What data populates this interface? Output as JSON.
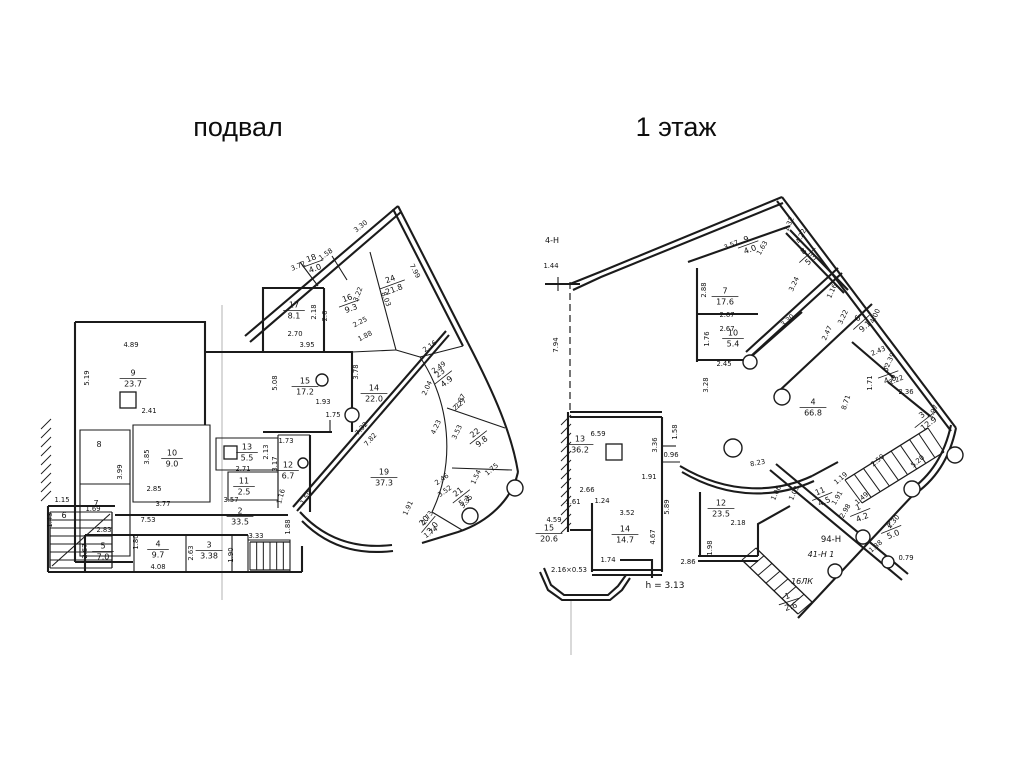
{
  "page": {
    "background": "#ffffff",
    "line_color": "#1b1b1b"
  },
  "plans": [
    {
      "id": "basement",
      "title": "подвал",
      "rooms": [
        {
          "n": "9",
          "a": "23.7",
          "x": 133,
          "y": 378
        },
        {
          "n": "10",
          "a": "9.0",
          "x": 172,
          "y": 458
        },
        {
          "n": "13",
          "a": "5.5",
          "x": 247,
          "y": 452
        },
        {
          "n": "11",
          "a": "2.5",
          "x": 244,
          "y": 486
        },
        {
          "n": "12",
          "a": "6.7",
          "x": 288,
          "y": 470
        },
        {
          "n": "5",
          "a": "7.0",
          "x": 103,
          "y": 551
        },
        {
          "n": "4",
          "a": "9.7",
          "x": 158,
          "y": 549
        },
        {
          "n": "3",
          "a": "3.38",
          "x": 209,
          "y": 550
        },
        {
          "n": "2",
          "a": "33.5",
          "x": 240,
          "y": 516
        },
        {
          "n": "15",
          "a": "17.2",
          "x": 305,
          "y": 386
        },
        {
          "n": "17",
          "a": "8.1",
          "x": 294,
          "y": 310
        },
        {
          "n": "16",
          "a": "9.3",
          "x": 349,
          "y": 303,
          "r": -20
        },
        {
          "n": "18",
          "a": "4.0",
          "x": 313,
          "y": 263,
          "r": -20
        },
        {
          "n": "24",
          "a": "21.8",
          "x": 392,
          "y": 284,
          "r": -20
        },
        {
          "n": "14",
          "a": "22.0",
          "x": 374,
          "y": 393
        },
        {
          "n": "19",
          "a": "37.3",
          "x": 384,
          "y": 477
        },
        {
          "n": "23",
          "a": "4.9",
          "x": 443,
          "y": 377,
          "r": -38
        },
        {
          "n": "22",
          "a": "9.8",
          "x": 478,
          "y": 437,
          "r": -38
        },
        {
          "n": "21",
          "a": "5.1",
          "x": 461,
          "y": 496,
          "r": -38
        },
        {
          "n": "20",
          "a": "3.0",
          "x": 428,
          "y": 524,
          "r": -50
        }
      ],
      "dims": [
        {
          "t": "4.89",
          "x": 131,
          "y": 347
        },
        {
          "t": "5.19",
          "x": 89,
          "y": 378,
          "r": -90
        },
        {
          "t": "2.41",
          "x": 149,
          "y": 413
        },
        {
          "t": "8",
          "x": 99,
          "y": 447,
          "s": 8
        },
        {
          "t": "7",
          "x": 96,
          "y": 506,
          "s": 8
        },
        {
          "t": "6",
          "x": 64,
          "y": 518,
          "s": 8
        },
        {
          "t": "3.99",
          "x": 122,
          "y": 472,
          "r": -90
        },
        {
          "t": "3.85",
          "x": 149,
          "y": 457,
          "r": -90
        },
        {
          "t": "2.85",
          "x": 154,
          "y": 491
        },
        {
          "t": "1.15",
          "x": 62,
          "y": 502
        },
        {
          "t": "1.69",
          "x": 93,
          "y": 511
        },
        {
          "t": "1.43",
          "x": 52,
          "y": 520,
          "r": -90
        },
        {
          "t": "2.83",
          "x": 104,
          "y": 532
        },
        {
          "t": "2.67",
          "x": 87,
          "y": 551,
          "r": -90
        },
        {
          "t": "7.53",
          "x": 148,
          "y": 522
        },
        {
          "t": "1.80",
          "x": 138,
          "y": 542,
          "r": -90
        },
        {
          "t": "4.08",
          "x": 158,
          "y": 569
        },
        {
          "t": "2.63",
          "x": 193,
          "y": 553,
          "r": -90
        },
        {
          "t": "1.90",
          "x": 233,
          "y": 555,
          "r": -90
        },
        {
          "t": "3.33",
          "x": 256,
          "y": 538
        },
        {
          "t": "3.77",
          "x": 163,
          "y": 506
        },
        {
          "t": "3.57",
          "x": 231,
          "y": 502
        },
        {
          "t": "2.71",
          "x": 243,
          "y": 471
        },
        {
          "t": "2.13",
          "x": 268,
          "y": 452,
          "r": -90
        },
        {
          "t": "3.17",
          "x": 277,
          "y": 464,
          "r": -90
        },
        {
          "t": "1.73",
          "x": 286,
          "y": 443
        },
        {
          "t": "1.16",
          "x": 283,
          "y": 497,
          "r": -75
        },
        {
          "t": "1.59",
          "x": 308,
          "y": 499,
          "r": -55
        },
        {
          "t": "1.88",
          "x": 290,
          "y": 527,
          "r": -90
        },
        {
          "t": "2.70",
          "x": 295,
          "y": 336
        },
        {
          "t": "3.95",
          "x": 307,
          "y": 347
        },
        {
          "t": "5.08",
          "x": 277,
          "y": 383,
          "r": -90
        },
        {
          "t": "1.93",
          "x": 323,
          "y": 404
        },
        {
          "t": "1.75",
          "x": 333,
          "y": 417
        },
        {
          "t": "2.18",
          "x": 316,
          "y": 312,
          "r": -90
        },
        {
          "t": "2.6",
          "x": 327,
          "y": 316,
          "r": -90
        },
        {
          "t": "3.72",
          "x": 299,
          "y": 268,
          "r": -22
        },
        {
          "t": "1.58",
          "x": 327,
          "y": 256,
          "r": -35
        },
        {
          "t": "3.30",
          "x": 362,
          "y": 228,
          "r": -38
        },
        {
          "t": "7.99",
          "x": 413,
          "y": 272,
          "r": 62
        },
        {
          "t": "3.22",
          "x": 360,
          "y": 295,
          "r": -70
        },
        {
          "t": "8.03",
          "x": 384,
          "y": 300,
          "r": 68
        },
        {
          "t": "2.25",
          "x": 361,
          "y": 324,
          "r": -28
        },
        {
          "t": "1.88",
          "x": 366,
          "y": 338,
          "r": -28
        },
        {
          "t": "7.32",
          "x": 363,
          "y": 430,
          "r": -48
        },
        {
          "t": "7.82",
          "x": 372,
          "y": 441,
          "r": -48
        },
        {
          "t": "3.78",
          "x": 358,
          "y": 372,
          "r": -90
        },
        {
          "t": "2.87",
          "x": 462,
          "y": 402,
          "r": -60
        },
        {
          "t": "2.04",
          "x": 429,
          "y": 389,
          "r": -65
        },
        {
          "t": "2.49",
          "x": 440,
          "y": 369,
          "r": -35
        },
        {
          "t": "2.16",
          "x": 431,
          "y": 348,
          "r": -35
        },
        {
          "t": "2.27",
          "x": 461,
          "y": 406,
          "r": -40
        },
        {
          "t": "4.23",
          "x": 438,
          "y": 428,
          "r": -65
        },
        {
          "t": "3.53",
          "x": 459,
          "y": 433,
          "r": -65
        },
        {
          "t": "1.75",
          "x": 493,
          "y": 471,
          "r": -40
        },
        {
          "t": "2.46",
          "x": 443,
          "y": 481,
          "r": -35
        },
        {
          "t": "3.52",
          "x": 446,
          "y": 493,
          "r": -35
        },
        {
          "t": "1.54",
          "x": 478,
          "y": 478,
          "r": -65
        },
        {
          "t": "3.35",
          "x": 468,
          "y": 503,
          "r": -50
        },
        {
          "t": "1.91",
          "x": 410,
          "y": 509,
          "r": -65
        },
        {
          "t": "2.73",
          "x": 429,
          "y": 519,
          "r": -55
        },
        {
          "t": "1.74",
          "x": 432,
          "y": 534,
          "r": -35
        }
      ]
    },
    {
      "id": "floor1",
      "title": "1 этаж",
      "rooms": [
        {
          "n": "9",
          "a": "4.0",
          "x": 748,
          "y": 244,
          "r": -20
        },
        {
          "n": "7",
          "a": "17.6",
          "x": 725,
          "y": 296
        },
        {
          "n": "10",
          "a": "5.4",
          "x": 733,
          "y": 338
        },
        {
          "n": "8",
          "a": "5.3",
          "x": 807,
          "y": 255,
          "r": -42
        },
        {
          "n": "6",
          "a": "9.1",
          "x": 861,
          "y": 322,
          "r": -42
        },
        {
          "n": "5",
          "a": "4.0",
          "x": 888,
          "y": 374,
          "r": -20
        },
        {
          "n": "3",
          "a": "12.9",
          "x": 925,
          "y": 419,
          "r": -38
        },
        {
          "n": "4",
          "a": "66.8",
          "x": 813,
          "y": 407
        },
        {
          "n": "13",
          "a": "36.2",
          "x": 580,
          "y": 444
        },
        {
          "n": "14",
          "a": "14.7",
          "x": 625,
          "y": 534
        },
        {
          "n": "15",
          "a": "20.6",
          "x": 549,
          "y": 533
        },
        {
          "n": "12",
          "a": "23.5",
          "x": 721,
          "y": 508
        },
        {
          "n": "11",
          "a": "4.5",
          "x": 822,
          "y": 496,
          "r": -22
        },
        {
          "n": "1",
          "a": "4.2",
          "x": 860,
          "y": 512,
          "r": -22
        },
        {
          "n": "2",
          "a": "5.0",
          "x": 891,
          "y": 529,
          "r": -22
        },
        {
          "n": "1",
          "a": "2.6",
          "x": 789,
          "y": 601,
          "r": -18
        }
      ],
      "dims": [
        {
          "t": "4-Н",
          "x": 552,
          "y": 243,
          "s": 8
        },
        {
          "t": "1.44",
          "x": 551,
          "y": 268
        },
        {
          "t": "7.94",
          "x": 558,
          "y": 345,
          "r": -90
        },
        {
          "t": "3.57",
          "x": 732,
          "y": 247,
          "r": -22
        },
        {
          "t": "1.63",
          "x": 764,
          "y": 249,
          "r": -60
        },
        {
          "t": "2.88",
          "x": 706,
          "y": 290,
          "r": -90
        },
        {
          "t": "2.67",
          "x": 727,
          "y": 317
        },
        {
          "t": "2.67",
          "x": 727,
          "y": 331
        },
        {
          "t": "1.76",
          "x": 709,
          "y": 339,
          "r": -90
        },
        {
          "t": "2.45",
          "x": 724,
          "y": 366
        },
        {
          "t": "3.30",
          "x": 789,
          "y": 322,
          "r": -42
        },
        {
          "t": "3.24",
          "x": 796,
          "y": 285,
          "r": -65
        },
        {
          "t": "1.16",
          "x": 834,
          "y": 292,
          "r": -65
        },
        {
          "t": "3.22",
          "x": 845,
          "y": 318,
          "r": -65
        },
        {
          "t": "4.00",
          "x": 877,
          "y": 317,
          "r": -65
        },
        {
          "t": "2.47",
          "x": 829,
          "y": 334,
          "r": -65
        },
        {
          "t": "1.32",
          "x": 791,
          "y": 225,
          "r": -65
        },
        {
          "t": "4.22",
          "x": 803,
          "y": 237,
          "r": -65
        },
        {
          "t": "2.43",
          "x": 879,
          "y": 353,
          "r": -22
        },
        {
          "t": "2.39",
          "x": 892,
          "y": 361,
          "r": -65
        },
        {
          "t": "2.22",
          "x": 897,
          "y": 382,
          "r": -22
        },
        {
          "t": "1.71",
          "x": 872,
          "y": 383,
          "r": -90
        },
        {
          "t": "2.36",
          "x": 906,
          "y": 394
        },
        {
          "t": "3.97",
          "x": 935,
          "y": 413,
          "r": -65
        },
        {
          "t": "8.71",
          "x": 848,
          "y": 403,
          "r": -72
        },
        {
          "t": "3.28",
          "x": 708,
          "y": 385,
          "r": -90
        },
        {
          "t": "6.59",
          "x": 598,
          "y": 436
        },
        {
          "t": "3.36",
          "x": 657,
          "y": 445,
          "r": -90
        },
        {
          "t": "0.96",
          "x": 671,
          "y": 457
        },
        {
          "t": "1.58",
          "x": 677,
          "y": 432,
          "r": -90
        },
        {
          "t": "8.23",
          "x": 758,
          "y": 465,
          "r": -10
        },
        {
          "t": "1.91",
          "x": 649,
          "y": 479
        },
        {
          "t": "2.66",
          "x": 587,
          "y": 492
        },
        {
          "t": "1.61",
          "x": 573,
          "y": 504
        },
        {
          "t": "1.24",
          "x": 602,
          "y": 503
        },
        {
          "t": "3.52",
          "x": 627,
          "y": 515
        },
        {
          "t": "5.89",
          "x": 669,
          "y": 507,
          "r": -90
        },
        {
          "t": "4.67",
          "x": 655,
          "y": 537,
          "r": -90
        },
        {
          "t": "4.59",
          "x": 554,
          "y": 522
        },
        {
          "t": "2.16×0.53",
          "x": 569,
          "y": 572
        },
        {
          "t": "1.74",
          "x": 608,
          "y": 562
        },
        {
          "t": "h = 3.13",
          "x": 665,
          "y": 588,
          "s": 9
        },
        {
          "t": "2.86",
          "x": 688,
          "y": 564
        },
        {
          "t": "2.18",
          "x": 738,
          "y": 525
        },
        {
          "t": "1.98",
          "x": 712,
          "y": 548,
          "r": -90
        },
        {
          "t": "1.06",
          "x": 778,
          "y": 494,
          "r": -65
        },
        {
          "t": "1.03",
          "x": 796,
          "y": 494,
          "r": -65
        },
        {
          "t": "1.19",
          "x": 842,
          "y": 480,
          "r": -40
        },
        {
          "t": "1.91",
          "x": 839,
          "y": 499,
          "r": -60
        },
        {
          "t": "1.49",
          "x": 863,
          "y": 500,
          "r": -40
        },
        {
          "t": "2.98",
          "x": 847,
          "y": 512,
          "r": -60
        },
        {
          "t": "2.30",
          "x": 895,
          "y": 523,
          "r": -50
        },
        {
          "t": "1.38",
          "x": 877,
          "y": 548,
          "r": -40
        },
        {
          "t": "2.50",
          "x": 879,
          "y": 462,
          "r": -40
        },
        {
          "t": "5.20",
          "x": 919,
          "y": 463,
          "r": -40
        },
        {
          "t": "0.79",
          "x": 906,
          "y": 560
        },
        {
          "t": "94-Н",
          "x": 831,
          "y": 542,
          "s": 8.5
        },
        {
          "t": "41-Н 1",
          "x": 821,
          "y": 557,
          "s": 8,
          "i": 1
        },
        {
          "t": "16ЛК",
          "x": 802,
          "y": 584,
          "s": 8,
          "i": 1
        }
      ]
    }
  ]
}
